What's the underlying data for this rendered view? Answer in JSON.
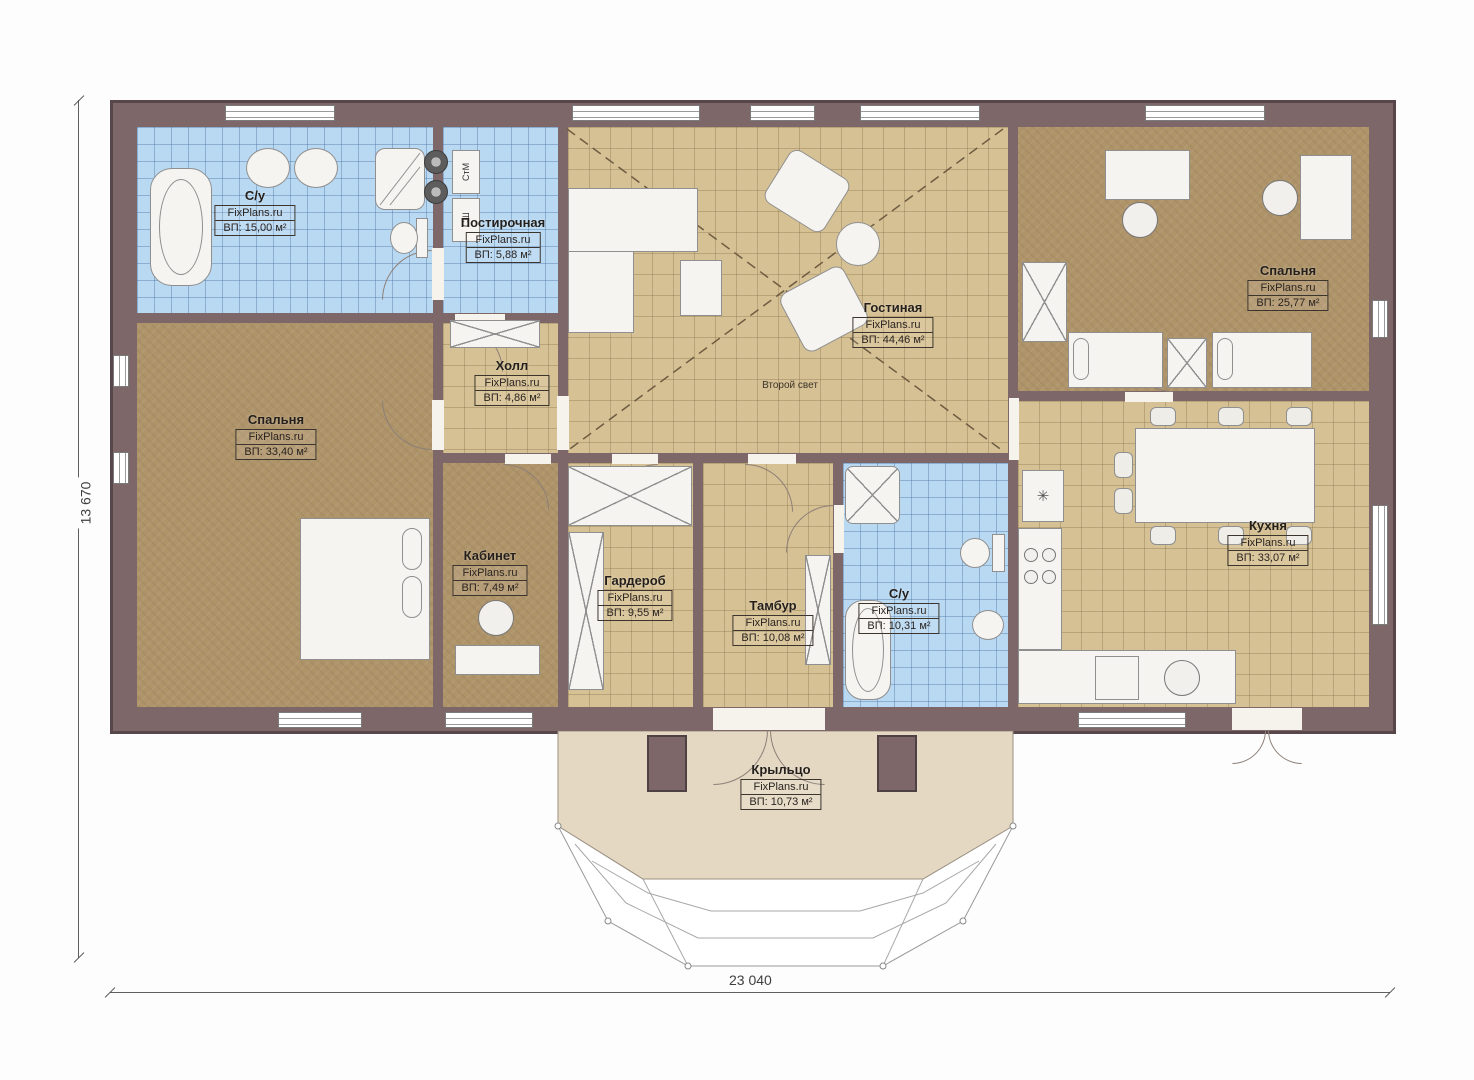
{
  "plan": {
    "brand": "FixPlans.ru",
    "dimensions": {
      "bottom": "23 040",
      "left": "13 670"
    },
    "colors": {
      "wall": "#7e6768",
      "tile_blue": "#b9d9f2",
      "tile_tan": "#d6c194",
      "carpet": "#af9469",
      "porch": "#e4d8c2"
    },
    "rooms": [
      {
        "name": "С/у",
        "area_label": "ВП: 15,00 м²"
      },
      {
        "name": "Постирочная",
        "area_label": "ВП: 5,88 м²"
      },
      {
        "name": "Холл",
        "area_label": "ВП: 4,86 м²"
      },
      {
        "name": "Гостиная",
        "area_label": "ВП: 44,46 м²",
        "note": "Второй свет"
      },
      {
        "name": "Спальня",
        "area_label": "ВП: 25,77 м²"
      },
      {
        "name": "Спальня",
        "area_label": "ВП: 33,40 м²"
      },
      {
        "name": "Кабинет",
        "area_label": "ВП: 7,49 м²"
      },
      {
        "name": "Гардероб",
        "area_label": "ВП: 9,55 м²"
      },
      {
        "name": "Тамбур",
        "area_label": "ВП: 10,08 м²"
      },
      {
        "name": "С/у",
        "area_label": "ВП: 10,31 м²"
      },
      {
        "name": "Кухня",
        "area_label": "ВП: 33,07 м²"
      },
      {
        "name": "Крыльцо",
        "area_label": "ВП: 10,73 м²"
      }
    ],
    "appliances": {
      "washer": "СтМ",
      "dryer": "СШ"
    },
    "symbols": {
      "snowflake": "✳"
    }
  }
}
